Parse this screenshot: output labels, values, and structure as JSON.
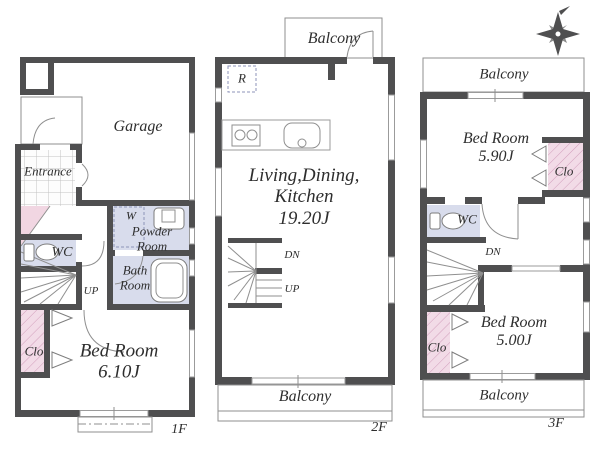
{
  "title": "House floor plan 1F-2F-3F",
  "colors": {
    "wall": "#4f4f50",
    "wet": "#d8dcec",
    "closet": "#f2dbe7",
    "closet_hatch": "#d29ebc",
    "line": "#9b9b9b",
    "text": "#2e2e2e"
  },
  "compass": {
    "icon": "compass-rose"
  },
  "floors": {
    "f1": {
      "floor_label": "1F",
      "garage": "Garage",
      "entrance": "Entrance",
      "wc": "WC",
      "up": "UP",
      "washer": "W",
      "powder_room": "Powder\nRoom",
      "bath_room": "Bath\nRoom",
      "closet": "Clo",
      "bedroom": "Bed Room\n6.10J"
    },
    "f2": {
      "floor_label": "2F",
      "balcony_top": "Balcony",
      "refrigerator": "R",
      "ldk": "Living,Dining,\nKitchen\n19.20J",
      "dn": "DN",
      "up": "UP",
      "balcony_bottom": "Balcony"
    },
    "f3": {
      "floor_label": "3F",
      "balcony_top": "Balcony",
      "bedroom_1": "Bed Room\n5.90J",
      "closet_1": "Clo",
      "wc": "WC",
      "dn": "DN",
      "bedroom_2": "Bed Room\n5.00J",
      "closet_2": "Clo",
      "balcony_bottom": "Balcony"
    }
  }
}
